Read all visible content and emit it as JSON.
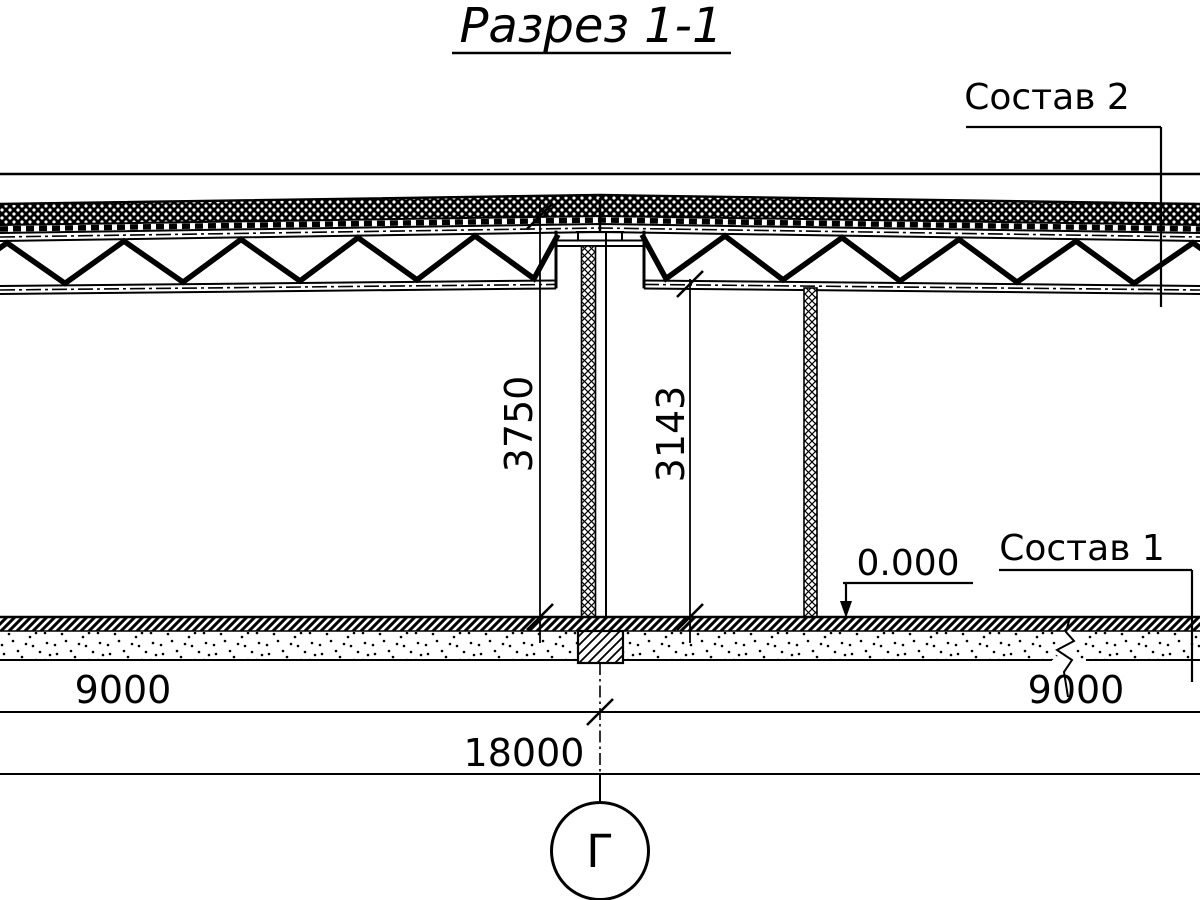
{
  "title": "Разрез 1-1",
  "callouts": {
    "roof_layers_label": "Состав 2",
    "floor_layers_label": "Состав 1"
  },
  "elevation": {
    "floor_level": "0.000"
  },
  "dimensions": {
    "apex_height": "3750",
    "truss_clearance": "3143",
    "bay_left": "9000",
    "bay_right": "9000",
    "total_span": "18000"
  },
  "axis": {
    "label": "Г"
  },
  "colors": {
    "ink": "#000000",
    "paper": "#ffffff"
  }
}
